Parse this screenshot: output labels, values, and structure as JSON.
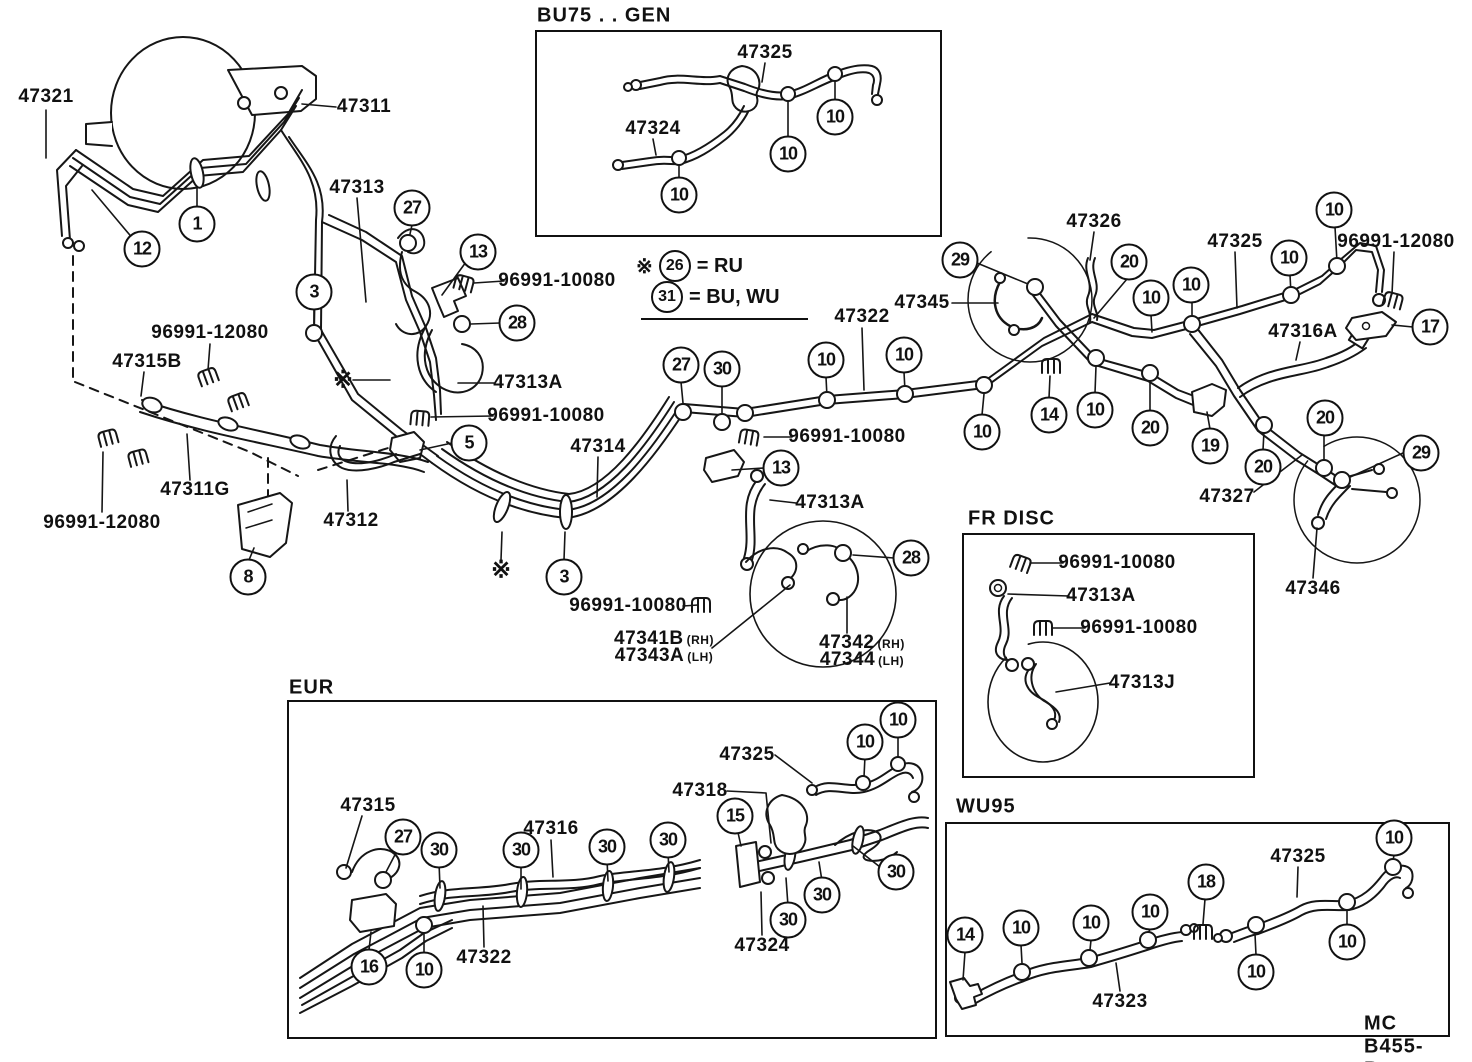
{
  "diagram": {
    "footer_code": "MC B455-B",
    "notes": {
      "line1_prefix": "※",
      "line1_circle": "26",
      "line1_text": "= RU",
      "line2_circle": "31",
      "line2_text": "= BU, WU"
    },
    "insets": [
      {
        "id": "bu75",
        "title": "BU75 . . GEN",
        "x": 535,
        "y": 30,
        "w": 403,
        "h": 203,
        "tx": 537,
        "ty": 16
      },
      {
        "id": "frdisc",
        "title": "FR DISC",
        "x": 962,
        "y": 533,
        "w": 289,
        "h": 241,
        "tx": 968,
        "ty": 519
      },
      {
        "id": "eur",
        "title": "EUR",
        "x": 287,
        "y": 700,
        "w": 646,
        "h": 335,
        "tx": 289,
        "ty": 688
      },
      {
        "id": "wu95",
        "title": "WU95",
        "x": 945,
        "y": 822,
        "w": 501,
        "h": 211,
        "tx": 956,
        "ty": 807
      }
    ],
    "part_labels": [
      {
        "t": "47321",
        "x": 46,
        "y": 97
      },
      {
        "t": "47311",
        "x": 364,
        "y": 107
      },
      {
        "t": "47313",
        "x": 357,
        "y": 188
      },
      {
        "t": "96991-10080",
        "x": 557,
        "y": 281
      },
      {
        "t": "47313A",
        "x": 528,
        "y": 383
      },
      {
        "t": "96991-10080",
        "x": 546,
        "y": 416
      },
      {
        "t": "96991-12080",
        "x": 210,
        "y": 333
      },
      {
        "t": "47315B",
        "x": 147,
        "y": 362
      },
      {
        "t": "96991-12080",
        "x": 102,
        "y": 523
      },
      {
        "t": "47311G",
        "x": 195,
        "y": 490
      },
      {
        "t": "47312",
        "x": 351,
        "y": 521
      },
      {
        "t": "47314",
        "x": 598,
        "y": 447
      },
      {
        "t": "96991-10080",
        "x": 847,
        "y": 437
      },
      {
        "t": "47313A",
        "x": 830,
        "y": 503
      },
      {
        "t": "96991-10080",
        "x": 628,
        "y": 606
      },
      {
        "t": "47341B",
        "s": "(RH)",
        "x": 664,
        "y": 639
      },
      {
        "t": "47343A",
        "s": "(LH)",
        "x": 664,
        "y": 656
      },
      {
        "t": "47342",
        "s": "(RH)",
        "x": 862,
        "y": 643
      },
      {
        "t": "47344",
        "s": "(LH)",
        "x": 862,
        "y": 660
      },
      {
        "t": "47322",
        "x": 862,
        "y": 317
      },
      {
        "t": "47345",
        "x": 922,
        "y": 303
      },
      {
        "t": "47326",
        "x": 1094,
        "y": 222
      },
      {
        "t": "47325",
        "x": 1235,
        "y": 242
      },
      {
        "t": "96991-12080",
        "x": 1396,
        "y": 242
      },
      {
        "t": "47316A",
        "x": 1303,
        "y": 332
      },
      {
        "t": "47327",
        "x": 1227,
        "y": 497
      },
      {
        "t": "47346",
        "x": 1313,
        "y": 589
      },
      {
        "t": "47325",
        "x": 765,
        "y": 53
      },
      {
        "t": "47324",
        "x": 653,
        "y": 129
      },
      {
        "t": "96991-10080",
        "x": 1117,
        "y": 563
      },
      {
        "t": "47313A",
        "x": 1101,
        "y": 596
      },
      {
        "t": "96991-10080",
        "x": 1139,
        "y": 628
      },
      {
        "t": "47313J",
        "x": 1142,
        "y": 683
      },
      {
        "t": "47315",
        "x": 368,
        "y": 806
      },
      {
        "t": "47316",
        "x": 551,
        "y": 829
      },
      {
        "t": "47325",
        "x": 747,
        "y": 755
      },
      {
        "t": "47318",
        "x": 700,
        "y": 791
      },
      {
        "t": "47322",
        "x": 484,
        "y": 958
      },
      {
        "t": "47324",
        "x": 762,
        "y": 946
      },
      {
        "t": "47325",
        "x": 1298,
        "y": 857
      },
      {
        "t": "47323",
        "x": 1120,
        "y": 1002
      }
    ],
    "callouts": [
      {
        "n": "1",
        "x": 197,
        "y": 224
      },
      {
        "n": "12",
        "x": 142,
        "y": 249
      },
      {
        "n": "27",
        "x": 412,
        "y": 208
      },
      {
        "n": "13",
        "x": 478,
        "y": 252
      },
      {
        "n": "3",
        "x": 314,
        "y": 292
      },
      {
        "n": "28",
        "x": 517,
        "y": 323
      },
      {
        "n": "5",
        "x": 469,
        "y": 443
      },
      {
        "n": "8",
        "x": 248,
        "y": 577
      },
      {
        "n": "3",
        "x": 564,
        "y": 577
      },
      {
        "n": "27",
        "x": 681,
        "y": 365
      },
      {
        "n": "30",
        "x": 722,
        "y": 369
      },
      {
        "n": "10",
        "x": 826,
        "y": 360
      },
      {
        "n": "10",
        "x": 904,
        "y": 355
      },
      {
        "n": "13",
        "x": 781,
        "y": 468
      },
      {
        "n": "28",
        "x": 911,
        "y": 558
      },
      {
        "n": "10",
        "x": 835,
        "y": 117
      },
      {
        "n": "10",
        "x": 788,
        "y": 154
      },
      {
        "n": "10",
        "x": 679,
        "y": 195
      },
      {
        "n": "29",
        "x": 960,
        "y": 260
      },
      {
        "n": "20",
        "x": 1129,
        "y": 262
      },
      {
        "n": "10",
        "x": 1151,
        "y": 298
      },
      {
        "n": "10",
        "x": 1191,
        "y": 285
      },
      {
        "n": "10",
        "x": 1289,
        "y": 258
      },
      {
        "n": "10",
        "x": 1334,
        "y": 210
      },
      {
        "n": "17",
        "x": 1430,
        "y": 327
      },
      {
        "n": "14",
        "x": 1049,
        "y": 415
      },
      {
        "n": "10",
        "x": 1095,
        "y": 410
      },
      {
        "n": "10",
        "x": 982,
        "y": 432
      },
      {
        "n": "20",
        "x": 1150,
        "y": 428
      },
      {
        "n": "19",
        "x": 1210,
        "y": 446
      },
      {
        "n": "20",
        "x": 1263,
        "y": 467
      },
      {
        "n": "20",
        "x": 1325,
        "y": 418
      },
      {
        "n": "29",
        "x": 1421,
        "y": 453
      },
      {
        "n": "27",
        "x": 403,
        "y": 837
      },
      {
        "n": "30",
        "x": 439,
        "y": 850
      },
      {
        "n": "30",
        "x": 521,
        "y": 850
      },
      {
        "n": "30",
        "x": 607,
        "y": 847
      },
      {
        "n": "30",
        "x": 668,
        "y": 840
      },
      {
        "n": "15",
        "x": 735,
        "y": 816
      },
      {
        "n": "10",
        "x": 865,
        "y": 742
      },
      {
        "n": "10",
        "x": 898,
        "y": 720
      },
      {
        "n": "30",
        "x": 896,
        "y": 872
      },
      {
        "n": "30",
        "x": 822,
        "y": 895
      },
      {
        "n": "30",
        "x": 788,
        "y": 920
      },
      {
        "n": "16",
        "x": 369,
        "y": 967
      },
      {
        "n": "10",
        "x": 424,
        "y": 970
      },
      {
        "n": "14",
        "x": 965,
        "y": 935
      },
      {
        "n": "10",
        "x": 1021,
        "y": 928
      },
      {
        "n": "10",
        "x": 1091,
        "y": 923
      },
      {
        "n": "10",
        "x": 1150,
        "y": 912
      },
      {
        "n": "18",
        "x": 1206,
        "y": 882
      },
      {
        "n": "10",
        "x": 1394,
        "y": 838
      },
      {
        "n": "10",
        "x": 1347,
        "y": 942
      },
      {
        "n": "10",
        "x": 1256,
        "y": 972
      }
    ],
    "symbols": [
      {
        "t": "※",
        "x": 343,
        "y": 380
      },
      {
        "t": "※",
        "x": 501,
        "y": 570
      }
    ]
  }
}
